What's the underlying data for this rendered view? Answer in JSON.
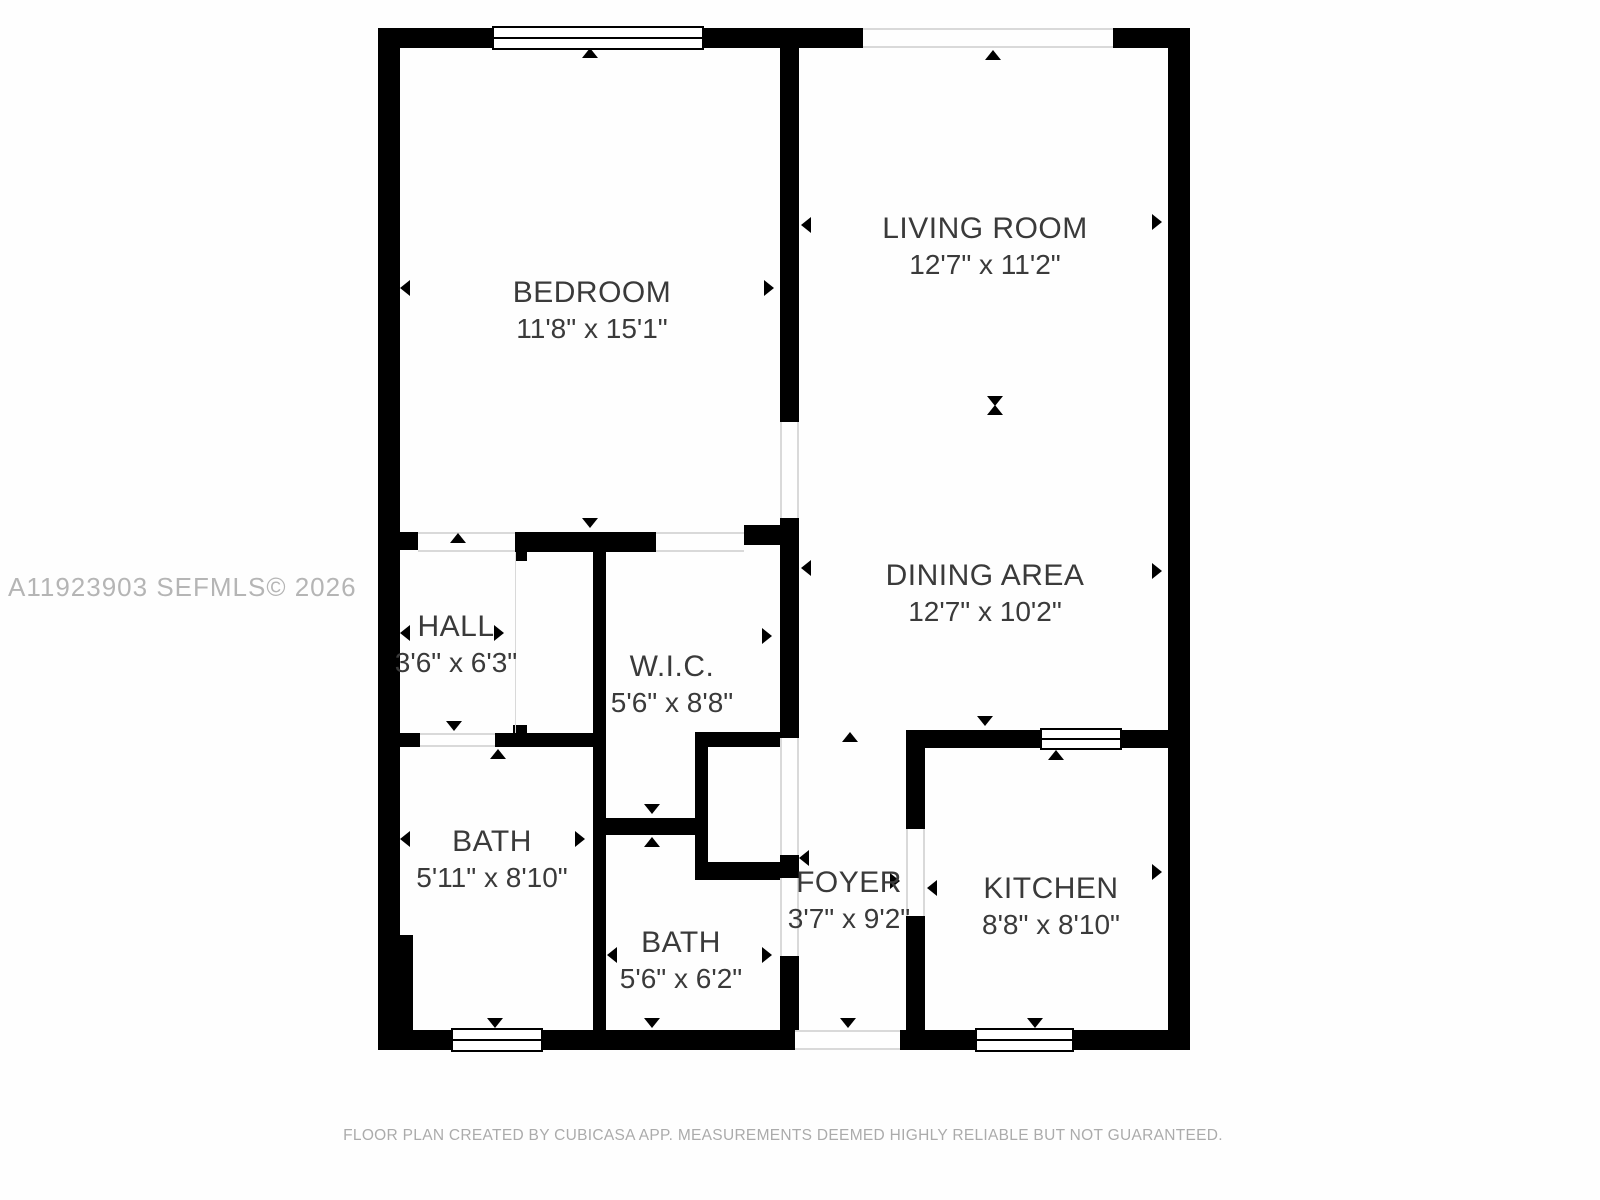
{
  "watermark": "A11923903  SEFMLS© 2026",
  "footer": "FLOOR PLAN CREATED BY CUBICASA APP. MEASUREMENTS DEEMED HIGHLY RELIABLE BUT NOT GUARANTEED.",
  "rooms": {
    "bedroom": {
      "name": "BEDROOM",
      "dims": "11'8\" x 15'1\""
    },
    "living_room": {
      "name": "LIVING ROOM",
      "dims": "12'7\" x 11'2\""
    },
    "dining_area": {
      "name": "DINING AREA",
      "dims": "12'7\" x 10'2\""
    },
    "hall": {
      "name": "HALL",
      "dims": "3'6\" x 6'3\""
    },
    "wic": {
      "name": "W.I.C.",
      "dims": "5'6\" x 8'8\""
    },
    "bath_1": {
      "name": "BATH",
      "dims": "5'11\" x 8'10\""
    },
    "bath_2": {
      "name": "BATH",
      "dims": "5'6\" x 6'2\""
    },
    "foyer": {
      "name": "FOYER",
      "dims": "3'7\" x 9'2\""
    },
    "kitchen": {
      "name": "KITCHEN",
      "dims": "8'8\" x 8'10\""
    }
  },
  "colors": {
    "wall": "#000000",
    "label_text": "#3a3a3a",
    "watermark_text": "#b5b5b5",
    "footer_text": "#ababab",
    "background": "#ffffff",
    "threshold_line": "#d9d9d9"
  }
}
